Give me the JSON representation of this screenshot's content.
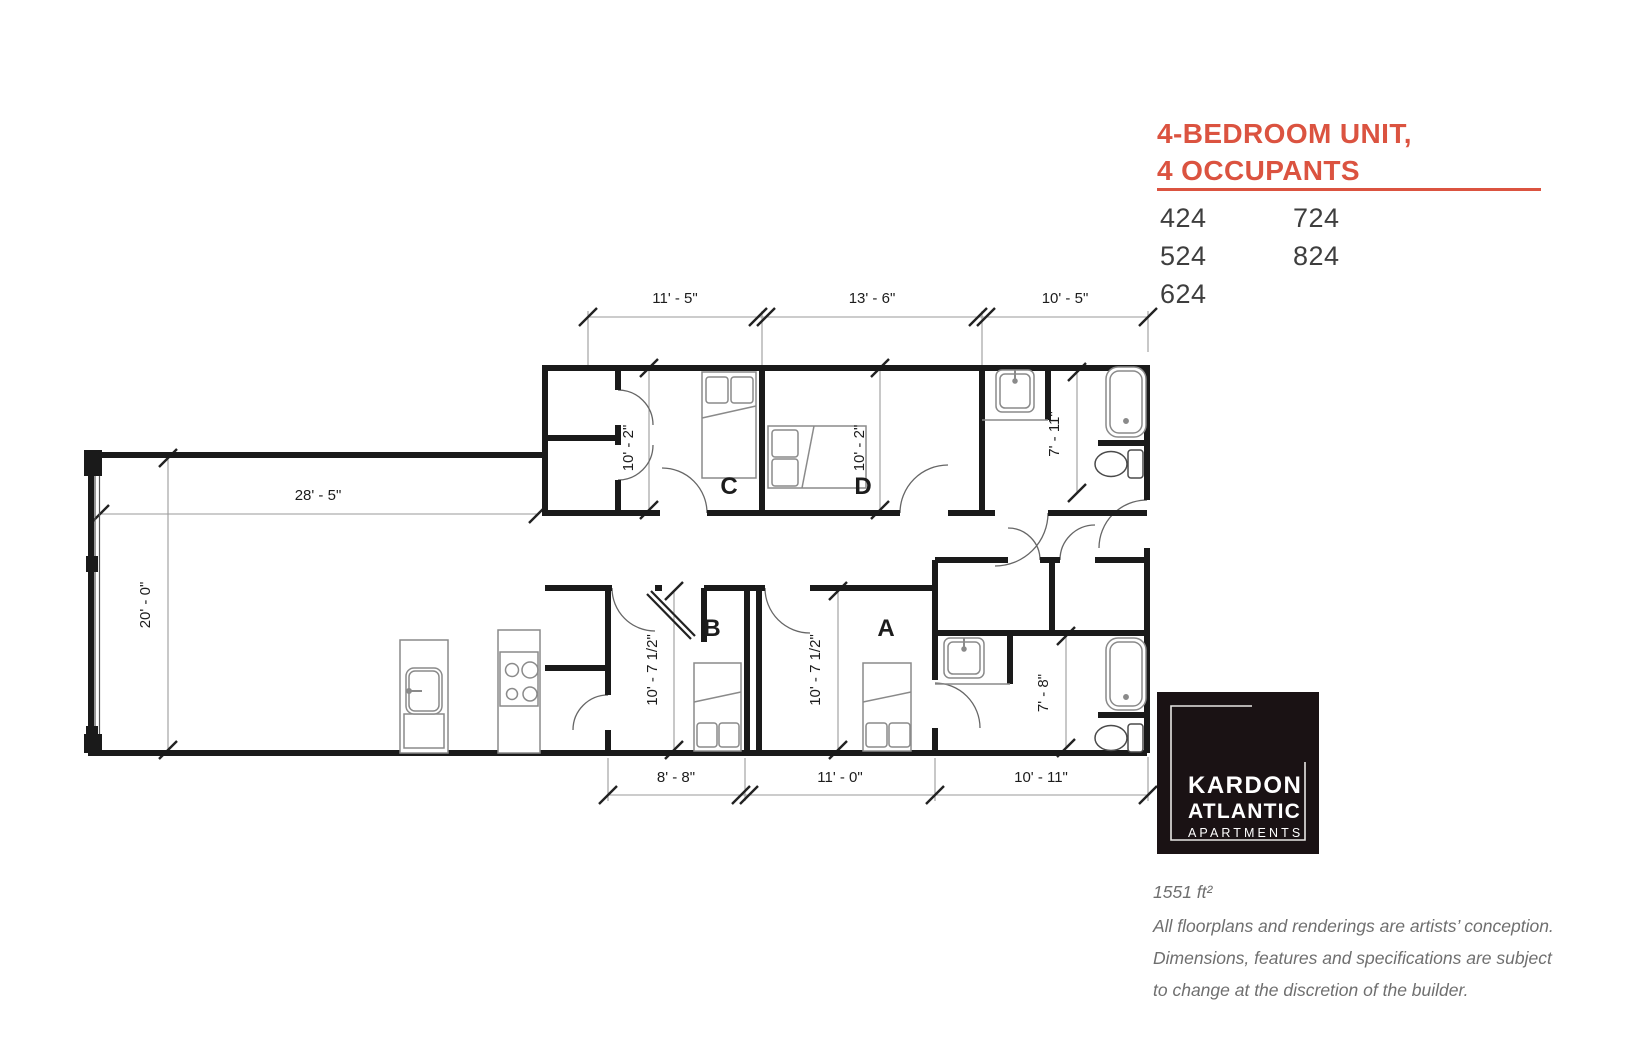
{
  "colors": {
    "accent": "#db5340",
    "wall": "#1a1a1a",
    "logo_background": "#1a1214",
    "dim_line": "#9a9a9a",
    "fixture": "#8a8a8a"
  },
  "panel": {
    "title_line1": "4-BEDROOM UNIT,",
    "title_line2": "4 OCCUPANTS",
    "units_col1": [
      "424",
      "524",
      "624"
    ],
    "units_col2": [
      "724",
      "824"
    ]
  },
  "logo": {
    "name_line1": "KARDON",
    "name_line2": "ATLANTIC",
    "name_line3": "APARTMENTS"
  },
  "footer": {
    "area": "1551 ft²",
    "disclaimer_line1": "All floorplans and renderings are artists’ conception.",
    "disclaimer_line2": "Dimensions, features and specifications are subject",
    "disclaimer_line3": "to change at the discretion of the builder."
  },
  "floorplan": {
    "room_labels": {
      "a": "A",
      "b": "B",
      "c": "C",
      "d": "D"
    },
    "dimensions": {
      "top_1": "11' - 5\"",
      "top_2": "13' - 6\"",
      "top_3": "10' - 5\"",
      "living_width": "28' - 5\"",
      "living_height": "20' - 0\"",
      "room_c_depth": "10' - 2\"",
      "room_d_depth": "10' - 2\"",
      "bath_upper_depth": "7' - 11\"",
      "room_b_depth": "10' - 7 1/2\"",
      "room_a_depth": "10' - 7 1/2\"",
      "bath_lower_depth": "7' - 8\"",
      "bottom_1": "8' - 8\"",
      "bottom_2": "11' - 0\"",
      "bottom_3": "10' - 11\""
    }
  }
}
